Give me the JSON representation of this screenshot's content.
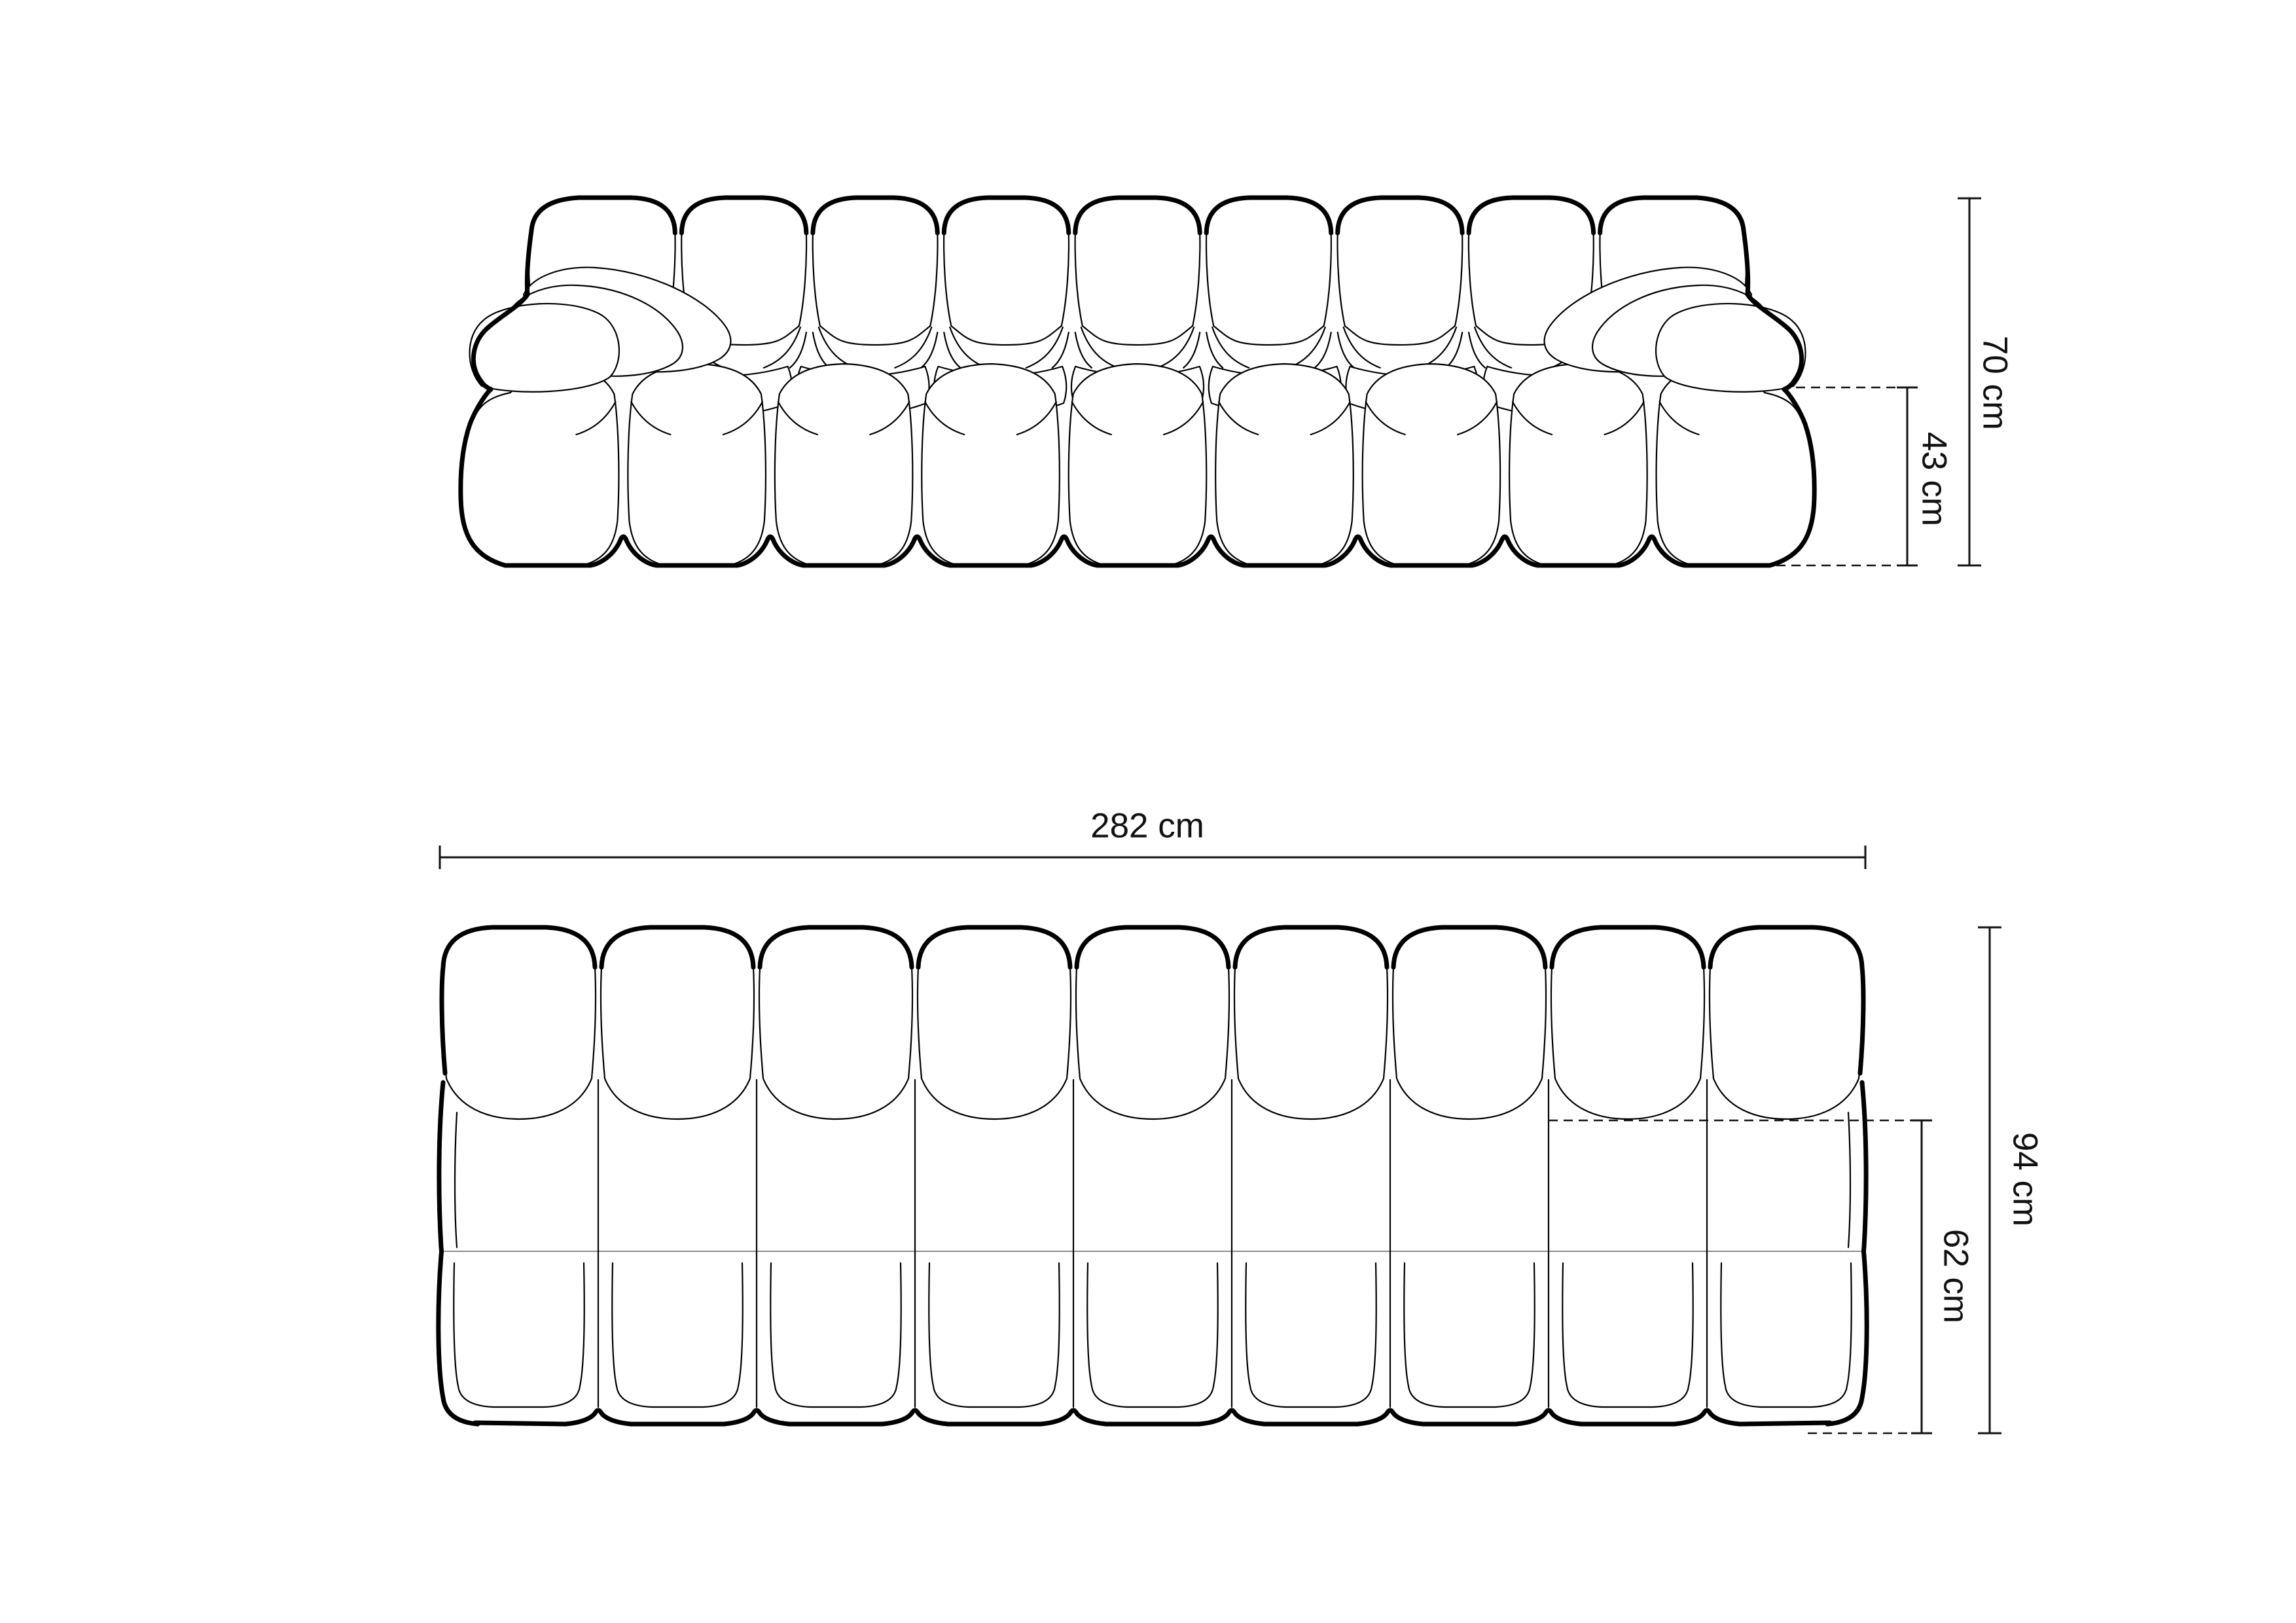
{
  "diagram": {
    "type": "furniture-dimension-drawing",
    "product": "modular bubble sofa",
    "views": {
      "front_elevation": {
        "dimensions": {
          "total_height": {
            "label": "70 cm"
          },
          "seat_height": {
            "label": "43 cm"
          }
        }
      },
      "top_plan": {
        "dimensions": {
          "total_width": {
            "label": "282 cm"
          },
          "total_depth": {
            "label": "94 cm"
          },
          "seat_depth": {
            "label": "62 cm"
          }
        }
      }
    },
    "colors": {
      "line": "#000000",
      "text": "#111111",
      "background": "#ffffff"
    },
    "units": "cm"
  }
}
